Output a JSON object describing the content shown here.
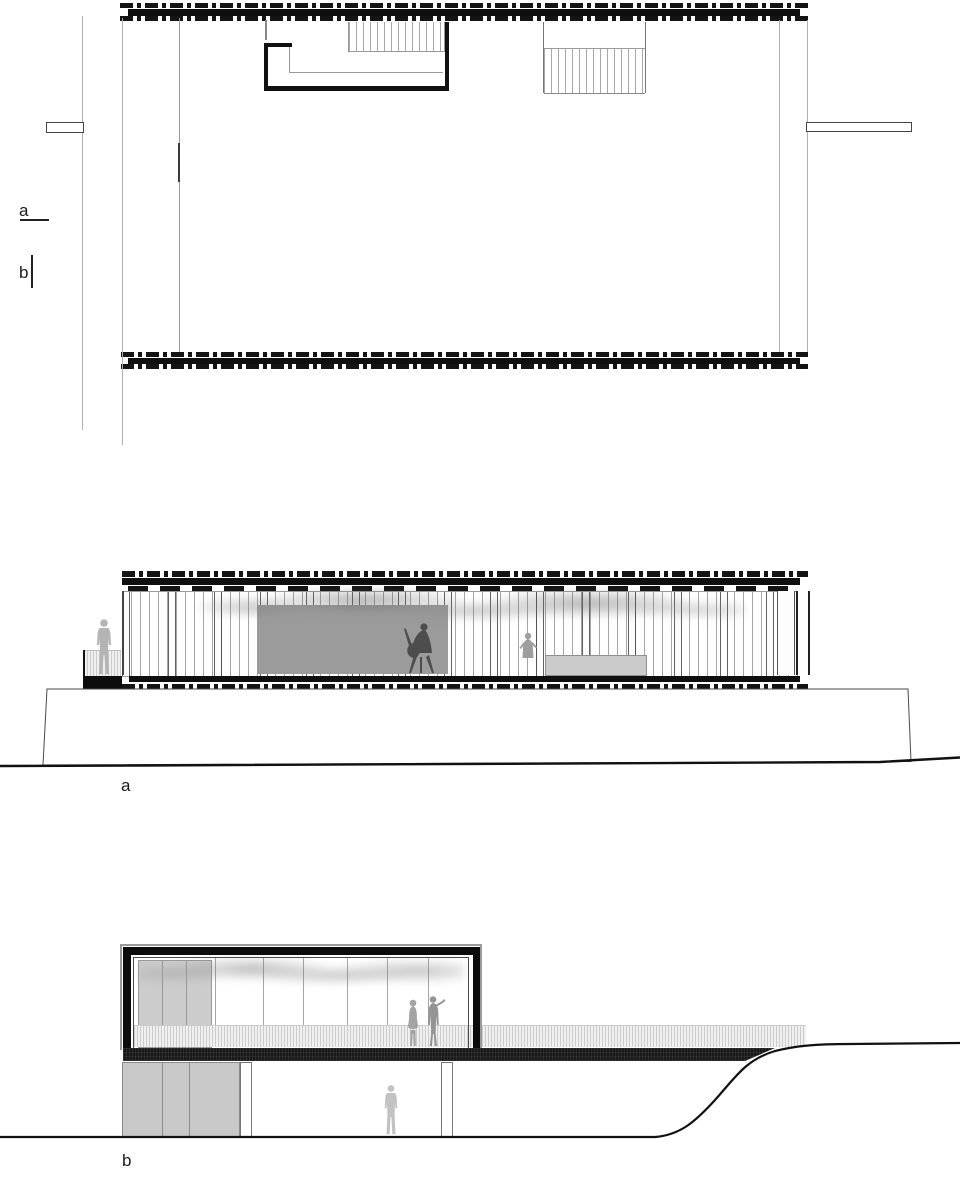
{
  "drawing": {
    "title": "architectural plan and sections",
    "plan": {
      "marker_a": "a",
      "marker_b": "b"
    },
    "section_a": {
      "label": "a"
    },
    "section_b": {
      "label": "b"
    },
    "colors": {
      "line_black": "#0f0f0f",
      "line_gray": "#b0b0b0",
      "interior_panel_gray": "#9b9b9b",
      "desk_gray": "#cbcbcb",
      "frame_black": "#0c0c0c",
      "frame_edge_gray": "#9a9a9a",
      "basement_panel_gray": "#c8c8c8",
      "figure_gray": "#b3b3b3",
      "cello_figure_gray": "#4d4d4d"
    }
  }
}
